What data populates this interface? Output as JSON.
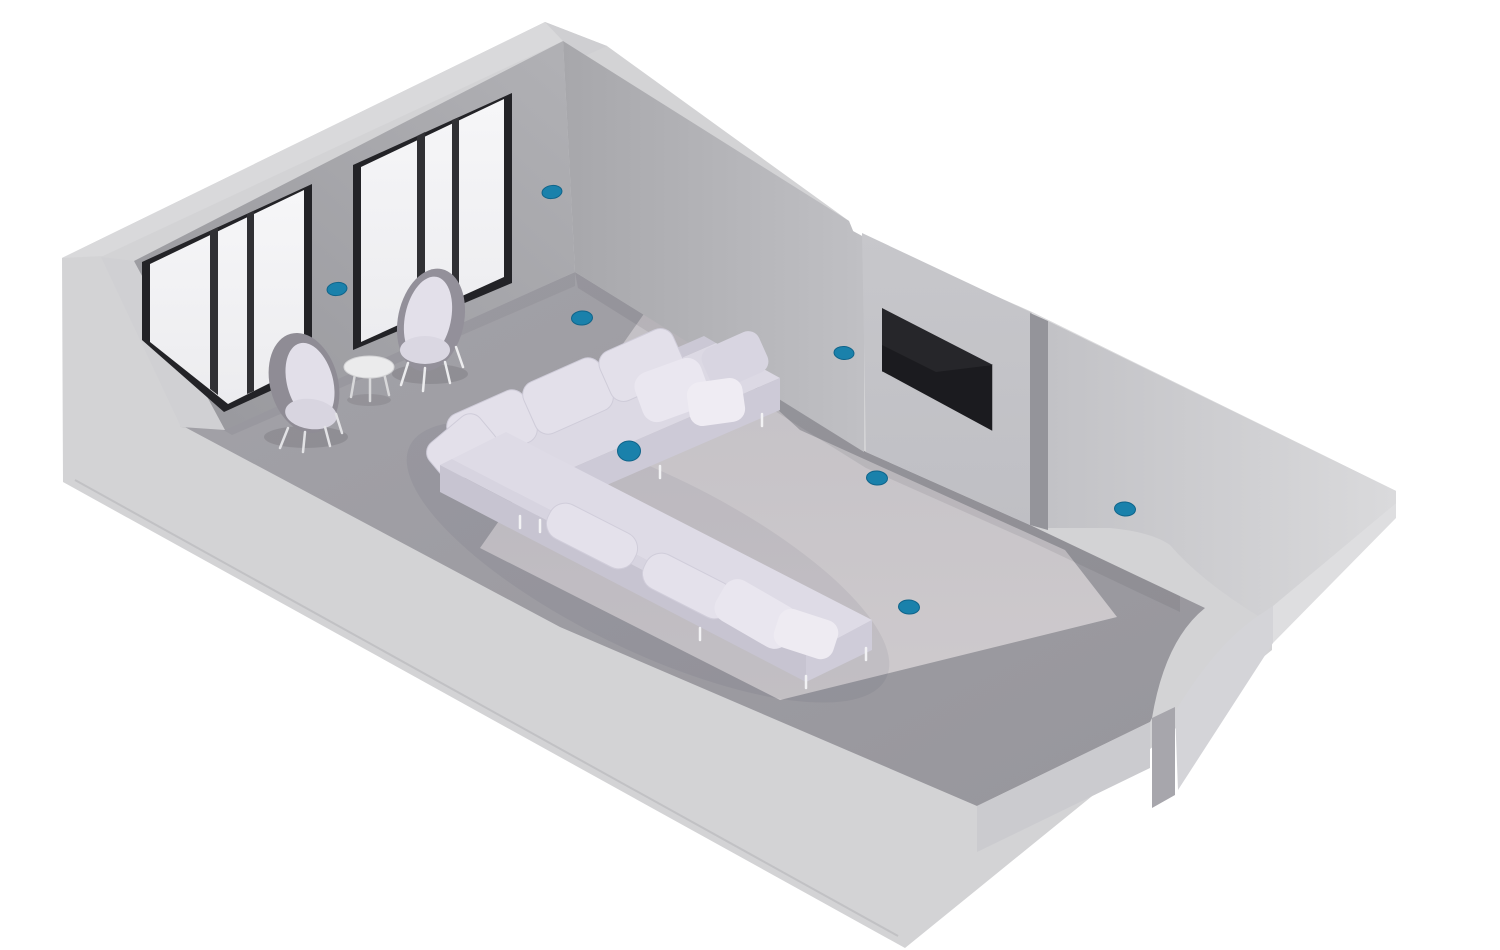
{
  "scene": {
    "type": "isometric-room-cutaway",
    "room": "living-room",
    "render_style": "3d-illustration",
    "background": "#ffffff"
  },
  "palette": {
    "sensor_accent": "#1a81ab",
    "sensor_edge": "#10648a",
    "window_wall": "#a5a5a9",
    "back_wall": "#b2b1b6",
    "tv_wall": "#c4c4c8",
    "right_wall": "#cccccf",
    "shell": "#d3d3d5",
    "floor": "#9c9ba1",
    "rug": "#c9c6ca",
    "window_frame": "#232327",
    "glass": "#f2f2f4",
    "sofa": "#dcd9e4",
    "chair_shell": "#908d97",
    "cushion": "#e3e0ea",
    "tv_screen": "#1b1b1f",
    "table_top": "#ebebec"
  },
  "objects": {
    "windows": {
      "count": 2,
      "panes_per_window": 3
    },
    "tv": {
      "mounted_on": "protruding-back-wall"
    },
    "sofa": {
      "kind": "l-shaped-sectional"
    },
    "armchairs": {
      "count": 2
    },
    "side_table": {
      "count": 1
    }
  },
  "sensors": {
    "count": 8,
    "color": "#1a81ab",
    "edge_color": "#10648a",
    "dots": [
      {
        "id": 1,
        "surface": "window-wall-right-of-windows",
        "x": 552,
        "y": 192,
        "rx": 10,
        "ry": 6.5,
        "rot": -8
      },
      {
        "id": 2,
        "surface": "window-wall-between-windows",
        "x": 337,
        "y": 289,
        "rx": 10,
        "ry": 6.5,
        "rot": -8
      },
      {
        "id": 3,
        "surface": "floor-near-back-corner",
        "x": 582,
        "y": 318,
        "rx": 10.5,
        "ry": 7,
        "rot": -4
      },
      {
        "id": 4,
        "surface": "back-wall-left-of-tv",
        "x": 844,
        "y": 353,
        "rx": 10,
        "ry": 6.5,
        "rot": 5
      },
      {
        "id": 5,
        "surface": "sofa-seat",
        "x": 629,
        "y": 451,
        "rx": 11.5,
        "ry": 10,
        "rot": 0
      },
      {
        "id": 6,
        "surface": "floor-in-front-of-tv",
        "x": 877,
        "y": 478,
        "rx": 10.5,
        "ry": 7,
        "rot": 4
      },
      {
        "id": 7,
        "surface": "right-wall",
        "x": 1125,
        "y": 509,
        "rx": 10.5,
        "ry": 7,
        "rot": 5
      },
      {
        "id": 8,
        "surface": "floor-center",
        "x": 909,
        "y": 607,
        "rx": 10.5,
        "ry": 7,
        "rot": 4
      }
    ]
  }
}
